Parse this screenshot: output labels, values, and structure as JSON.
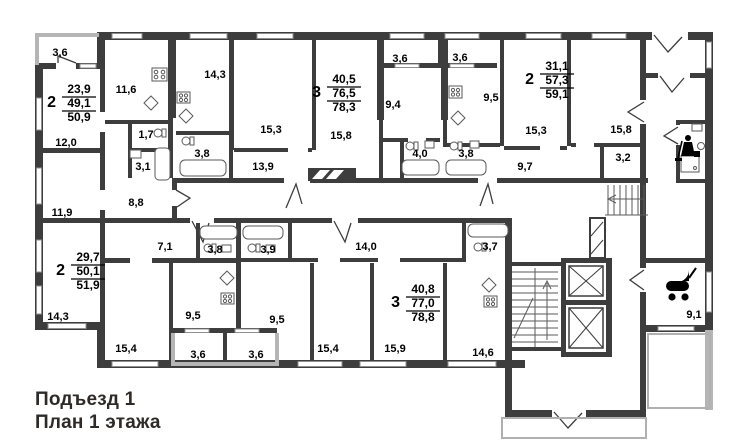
{
  "caption": {
    "line1": "Подъезд 1",
    "line2": "План 1 этажа"
  },
  "apartments": [
    {
      "id": "apt-1",
      "rooms": "2",
      "living_area": "23,9",
      "area": "49,1",
      "total_area": "50,9"
    },
    {
      "id": "apt-2",
      "rooms": "3",
      "living_area": "40,5",
      "area": "76,5",
      "total_area": "78,3"
    },
    {
      "id": "apt-3",
      "rooms": "2",
      "living_area": "31,1",
      "area": "57,3",
      "total_area": "59,1"
    },
    {
      "id": "apt-4",
      "rooms": "2",
      "living_area": "29,7",
      "area": "50,1",
      "total_area": "51,9"
    },
    {
      "id": "apt-5",
      "rooms": "3",
      "living_area": "40,8",
      "area": "77,0",
      "total_area": "78,8"
    }
  ],
  "room_labels": [
    {
      "name": "balcony-apt1",
      "value": "3,6"
    },
    {
      "name": "kitchen-apt1",
      "value": "11,6"
    },
    {
      "name": "kitchen-apt2",
      "value": "14,3"
    },
    {
      "name": "room1-apt1",
      "value": "12,0"
    },
    {
      "name": "wc-hall-apt1",
      "value": "1,7"
    },
    {
      "name": "bath-apt1",
      "value": "3,1"
    },
    {
      "name": "wc-apt2",
      "value": "3,8"
    },
    {
      "name": "hall-apt1",
      "value": "8,8"
    },
    {
      "name": "room2-apt1",
      "value": "11,9"
    },
    {
      "name": "room1-apt2",
      "value": "15,3"
    },
    {
      "name": "room2-apt2",
      "value": "15,8"
    },
    {
      "name": "hall-apt2",
      "value": "13,9"
    },
    {
      "name": "loggia-apt2",
      "value": "3,6"
    },
    {
      "name": "loggia-apt3",
      "value": "3,6"
    },
    {
      "name": "room3-apt2",
      "value": "9,4"
    },
    {
      "name": "kitchen-apt3",
      "value": "9,5"
    },
    {
      "name": "bath-apt2",
      "value": "4,0"
    },
    {
      "name": "bath-apt3",
      "value": "3,8"
    },
    {
      "name": "room1-apt3",
      "value": "15,3"
    },
    {
      "name": "room2-apt3",
      "value": "15,8"
    },
    {
      "name": "hall-apt3",
      "value": "9,7"
    },
    {
      "name": "wardrobe-apt3",
      "value": "3,2"
    },
    {
      "name": "hall-apt4",
      "value": "7,1"
    },
    {
      "name": "bath-apt4",
      "value": "3,8"
    },
    {
      "name": "bath-apt5",
      "value": "3,9"
    },
    {
      "name": "hall-apt5",
      "value": "14,0"
    },
    {
      "name": "bath2-apt5",
      "value": "3,7"
    },
    {
      "name": "room1-apt4",
      "value": "14,3"
    },
    {
      "name": "kitchen-apt4",
      "value": "9,5"
    },
    {
      "name": "room3-apt5",
      "value": "9,5"
    },
    {
      "name": "room2-apt4",
      "value": "15,4"
    },
    {
      "name": "loggia-apt4",
      "value": "3,6"
    },
    {
      "name": "loggia-apt5",
      "value": "3,6"
    },
    {
      "name": "room1-apt5",
      "value": "15,4"
    },
    {
      "name": "room2-apt5",
      "value": "15,9"
    },
    {
      "name": "kitchen-apt5",
      "value": "14,6"
    },
    {
      "name": "stroller-room",
      "value": "9,1"
    }
  ],
  "icons": [
    {
      "name": "cleaning-room-icon"
    },
    {
      "name": "stroller-room-icon"
    }
  ],
  "colors": {
    "wall": "#3d3d3d",
    "light_wall": "#b5b5b5",
    "text": "#000000"
  }
}
